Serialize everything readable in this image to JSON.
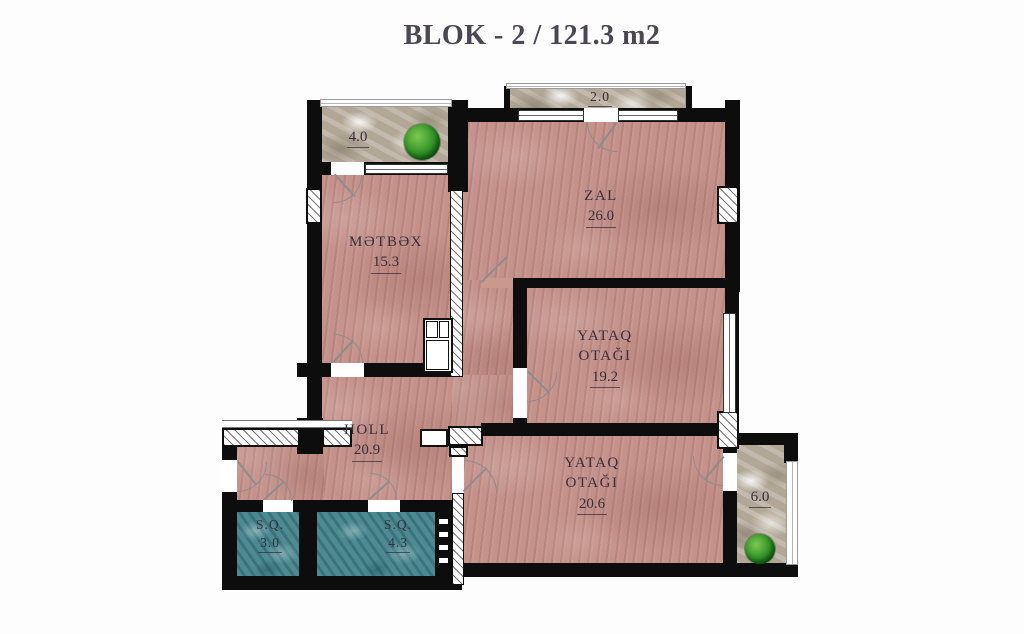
{
  "title": "BLOK - 2 / 121.3 m2",
  "rooms": {
    "zal": {
      "name": "ZAL",
      "area": "26.0"
    },
    "metbex": {
      "name": "MƏTBƏX",
      "area": "15.3"
    },
    "yataq19": {
      "name": "YATAQ OTAĞI",
      "area": "19.2"
    },
    "holl": {
      "name": "HOLL",
      "area": "20.9"
    },
    "yataq20": {
      "name": "YATAQ OTAĞI",
      "area": "20.6"
    },
    "sq3": {
      "name": "S.Q.",
      "area": "3.0"
    },
    "sq4": {
      "name": "S.Q.",
      "area": "4.3"
    },
    "balcony_top": {
      "area": "4.0"
    },
    "balcony_zal": {
      "area": "2.0"
    },
    "balcony_right": {
      "area": "6.0"
    }
  },
  "colors": {
    "wall": "#0d0d0d",
    "wood_floor": "#c4928a",
    "tile_floor": "#4d8a92",
    "stone_floor": "#b2a796",
    "label_text": "#352f3e",
    "plant_green": "#2e8f25",
    "background": "#fdfdfd"
  }
}
